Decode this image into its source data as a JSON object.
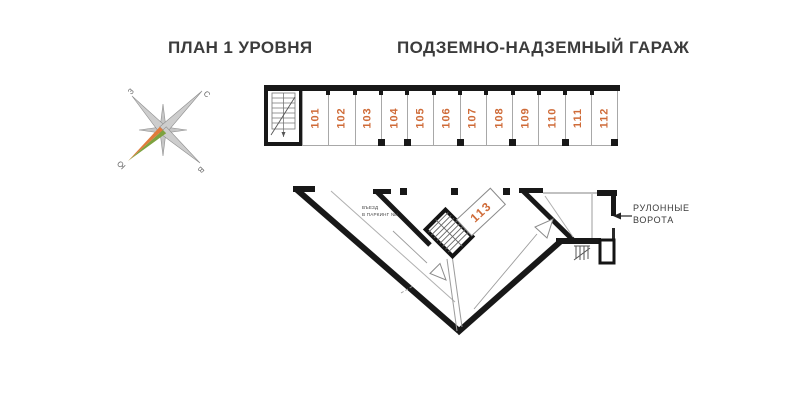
{
  "header": {
    "title_left": "ПЛАН 1 УРОВНЯ",
    "title_right": "ПОДЗЕМНО-НАДЗЕМНЫЙ ГАРАЖ"
  },
  "compass": {
    "north": "С",
    "south": "Ю",
    "west": "З",
    "east": "В"
  },
  "parking_row": {
    "stalls": [
      "101",
      "102",
      "103",
      "104",
      "105",
      "106",
      "107",
      "108",
      "109",
      "110",
      "111",
      "112"
    ]
  },
  "central_unit": {
    "label": "113"
  },
  "labels": {
    "ramp_line1": "ВЪЕЗД",
    "ramp_line2": "В ПАРКИНГ №1",
    "gates_line1": "РУЛОННЫЕ",
    "gates_line2": "ВОРОТА"
  },
  "colors": {
    "wall": "#181818",
    "thin_line": "#9c9c9c",
    "unit_number_orange": "#cf6b38",
    "heading_text": "#3c3c3c",
    "compass_orange": "#e07b3b",
    "compass_green": "#7da23f",
    "compass_silver": "#cdcdcd"
  }
}
